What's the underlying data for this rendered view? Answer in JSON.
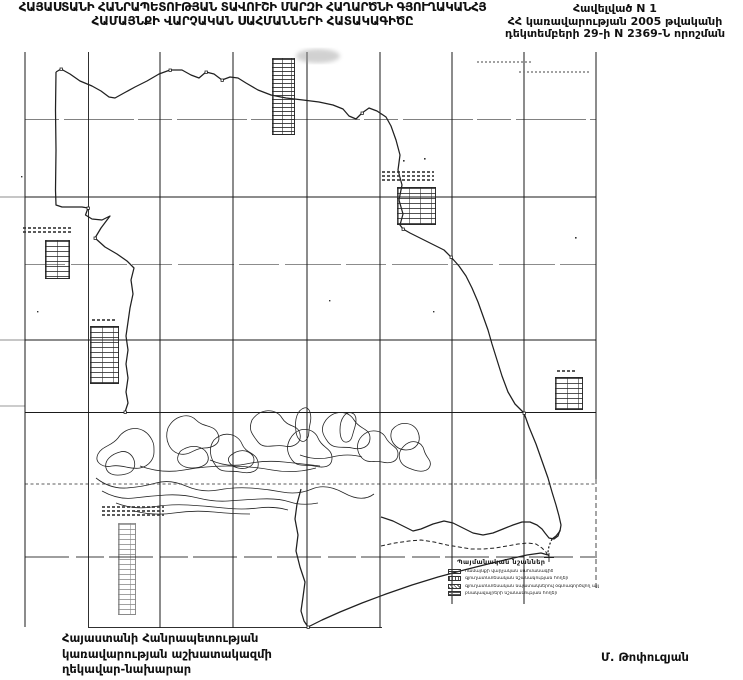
{
  "page": {
    "colors": {
      "ink": "#1a1a1a",
      "paper": "#ffffff"
    },
    "title": {
      "line1": "ՀԱՅԱՍՏԱՆԻ ՀԱՆՐԱՊԵՏՈՒԹՅԱՆ ՏԱՎՈՒՇԻ ՄԱՐԶԻ ՀԱՂԱՐԾՆԻ ԳՅՈՒՂԱԿԱՆՀՅ",
      "line2": "ՀԱՄԱՅՆՔԻ ՎԱՐՉԱԿԱՆ ՍԱՀՄԱՆՆԵՐԻ ՀԱՏԱԿԱԳԻԾԸ"
    },
    "annex": {
      "line1": "Հավելված N 1",
      "line2": "ՀՀ կառավարության 2005 թվականի",
      "line3": "դեկտեմբերի 29-ի N 2369-Ն որոշման"
    },
    "legend": {
      "title": "Պայմանական նշաններ",
      "items": [
        {
          "symbol": "boundary-line-swatch",
          "label": "համայնքի վարչական սահմանագիծ"
        },
        {
          "symbol": "dotted-swatch",
          "label": "գյուղատնտեսական նշանակության հողեր"
        },
        {
          "symbol": "diagonal-hatch-swatch",
          "label": "գյուղատնտեսական նպատակներով օգտագործվող այլ հողեր"
        },
        {
          "symbol": "vertical-hatch-swatch",
          "label": "բնակավայրերի նշանակության հողեր"
        }
      ]
    },
    "footer": {
      "left_line1": "Հայաստանի Հանրապետության",
      "left_line2": "կառավարության աշխատակազմի",
      "left_line3": "ղեկավար-նախարար",
      "signature": "Մ. Թոփուզյան"
    }
  }
}
